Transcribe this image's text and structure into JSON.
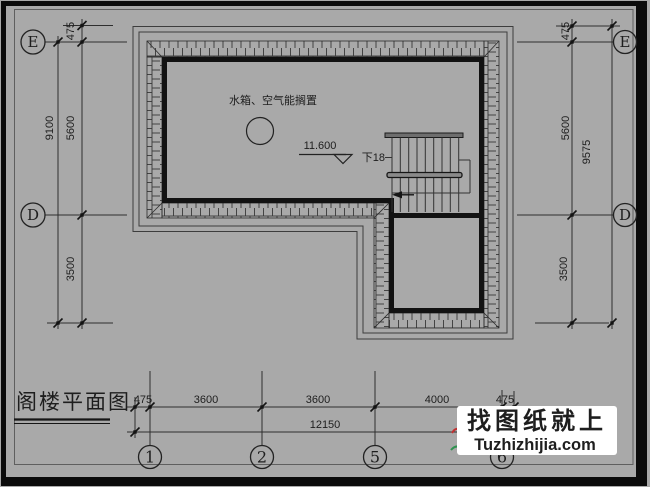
{
  "drawing": {
    "title": "阁楼平面图",
    "room_label": "水箱、空气能搁置",
    "level_value": "11.600",
    "stair_down": "下18"
  },
  "axes": {
    "E": "E",
    "D": "D",
    "c1": "1",
    "c2": "2",
    "c5": "5",
    "c6": "6"
  },
  "dims": {
    "left": {
      "eave": "475",
      "total": "9100",
      "upper": "5600",
      "lower": "3500"
    },
    "right": {
      "eave": "475",
      "upper": "5600",
      "total": "9575",
      "lower": "3500"
    },
    "bottom": {
      "eave_left": "475",
      "seg1": "3600",
      "seg2": "3600",
      "seg3": "4000",
      "eave_right": "475",
      "total": "12150"
    }
  },
  "watermark": {
    "name": "找图纸就上",
    "url": "Tuzhizhijia.com",
    "url_color": "#0000bb"
  },
  "colors": {
    "paper": "#a9a9a9",
    "ink": "#1e1e1e",
    "frame": "#0b0b0b",
    "logo_red": "#c03030",
    "logo_green": "#2f9350"
  }
}
